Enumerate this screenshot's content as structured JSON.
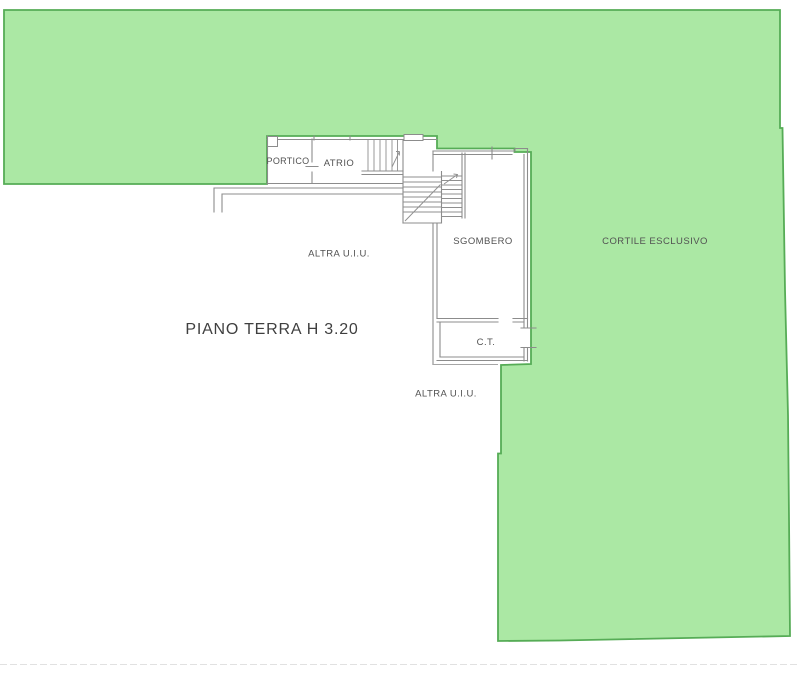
{
  "plan": {
    "title": "PIANO TERRA H 3.20",
    "rooms": {
      "portico": "PORTICO",
      "atrio": "ATRIO",
      "sgombero": "SGOMBERO",
      "ct": "C.T.",
      "altra_uiu_upper": "ALTRA U.I.U.",
      "altra_uiu_lower": "ALTRA U.I.U.",
      "cortile": "CORTILE ESCLUSIVO"
    },
    "colors": {
      "courtyard_fill": "#abe8a4",
      "courtyard_border": "#56ac56",
      "wall": "#8c8c8c",
      "label_text": "#525252",
      "title_text": "#3f3f3f",
      "background": "#ffffff"
    }
  }
}
